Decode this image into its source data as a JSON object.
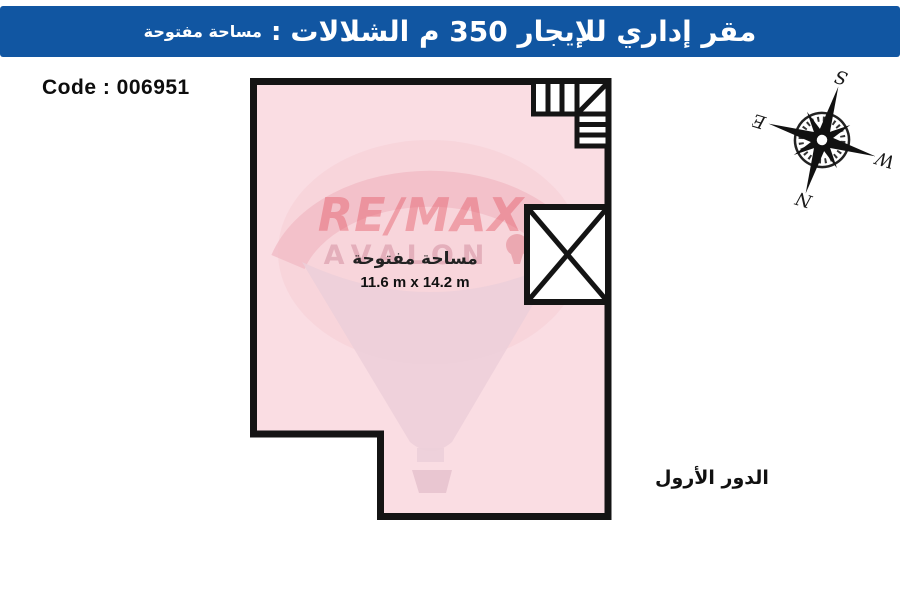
{
  "header": {
    "title_main": "مقر إداري للإيجار 350 م الشلالات",
    "separator": " : ",
    "title_sub": "مساحة مفتوحة",
    "bg_color": "#1156a2",
    "text_color": "#ffffff"
  },
  "code": {
    "label": "Code : 006951"
  },
  "plan": {
    "area_label": "مساحة مفتوحة",
    "dimensions": "11.6 m x 14.2 m",
    "fill_color": "#fadde3",
    "outline_color": "#141414"
  },
  "floor_label": "الدور الأرول",
  "watermark": {
    "brand": "RE/MAX",
    "sub": "AVALON",
    "brand_color": "#e2505e",
    "balloon_color": "#eccfd9"
  },
  "compass": {
    "n": "N",
    "s": "S",
    "e": "E",
    "w": "W"
  }
}
